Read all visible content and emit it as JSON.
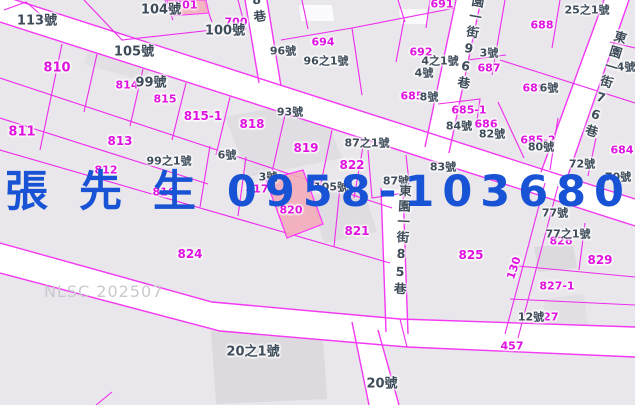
{
  "map": {
    "watermark": "NLSC 202507",
    "overlay_contact": {
      "name": "張先生",
      "phone": "0958-103680",
      "display": "張 先 生 0958-103680",
      "color": "#1753d4"
    },
    "highlighted_parcel": {
      "id": "820",
      "fill": "#f3abb9"
    },
    "colors": {
      "parcel_line": "#ee2bee",
      "road_edge_line": "#f438f4",
      "parcel_label": "#e012e0",
      "house_label": "#3e4c5a",
      "road_fill": "#ffffff",
      "map_bg": "#e9e7eb",
      "building_fill": "#dcdade",
      "watermark_color": "#c9c9cf",
      "overlay_blue": "#1753d4"
    },
    "street_labels": [
      {
        "t": "8巷",
        "x": 257,
        "y": -8,
        "r": -8
      },
      {
        "t": "園一街96巷",
        "x": 469,
        "y": -6,
        "r": 10
      },
      {
        "t": "東園一街76巷",
        "x": 604,
        "y": 28,
        "r": 17
      },
      {
        "t": "東園一街85巷",
        "x": 401,
        "y": 184,
        "r": 3
      }
    ],
    "parcel_labels": [
      {
        "t": "701",
        "x": 186,
        "y": 5
      },
      {
        "t": "700",
        "x": 236,
        "y": 22
      },
      {
        "t": "691",
        "x": 442,
        "y": 4
      },
      {
        "t": "692",
        "x": 421,
        "y": 52
      },
      {
        "t": "694",
        "x": 323,
        "y": 42
      },
      {
        "t": "687",
        "x": 489,
        "y": 68
      },
      {
        "t": "688",
        "x": 542,
        "y": 25
      },
      {
        "t": "689",
        "x": 534,
        "y": 88
      },
      {
        "t": "685",
        "x": 412,
        "y": 96
      },
      {
        "t": "685-1",
        "x": 469,
        "y": 110
      },
      {
        "t": "686",
        "x": 486,
        "y": 124
      },
      {
        "t": "685-2",
        "x": 538,
        "y": 140
      },
      {
        "t": "684",
        "x": 622,
        "y": 150
      },
      {
        "t": "810",
        "x": 57,
        "y": 68,
        "s": 13
      },
      {
        "t": "811",
        "x": 22,
        "y": 132,
        "s": 13
      },
      {
        "t": "812",
        "x": 106,
        "y": 170
      },
      {
        "t": "813",
        "x": 120,
        "y": 141,
        "s": 12
      },
      {
        "t": "814",
        "x": 127,
        "y": 85
      },
      {
        "t": "815",
        "x": 165,
        "y": 99
      },
      {
        "t": "815-1",
        "x": 203,
        "y": 116,
        "s": 12
      },
      {
        "t": "816",
        "x": 164,
        "y": 192
      },
      {
        "t": "817",
        "x": 257,
        "y": 189
      },
      {
        "t": "818",
        "x": 252,
        "y": 124,
        "s": 12
      },
      {
        "t": "819",
        "x": 306,
        "y": 148,
        "s": 12
      },
      {
        "t": "820",
        "x": 291,
        "y": 210
      },
      {
        "t": "821",
        "x": 357,
        "y": 231,
        "s": 12
      },
      {
        "t": "822",
        "x": 352,
        "y": 165,
        "s": 12
      },
      {
        "t": "824",
        "x": 190,
        "y": 254,
        "s": 12
      },
      {
        "t": "825",
        "x": 471,
        "y": 255,
        "s": 12
      },
      {
        "t": "826",
        "x": 561,
        "y": 241
      },
      {
        "t": "827",
        "x": 547,
        "y": 317
      },
      {
        "t": "827-1",
        "x": 557,
        "y": 286
      },
      {
        "t": "829",
        "x": 600,
        "y": 260,
        "s": 12
      },
      {
        "t": "457",
        "x": 512,
        "y": 346
      },
      {
        "t": "130",
        "x": 514,
        "y": 268,
        "r": -72
      }
    ],
    "house_labels": [
      {
        "t": "113號",
        "x": 37,
        "y": 21,
        "s": 13
      },
      {
        "t": "104號",
        "x": 161,
        "y": 10,
        "s": 13
      },
      {
        "t": "105號",
        "x": 134,
        "y": 52,
        "s": 13
      },
      {
        "t": "100號",
        "x": 225,
        "y": 31,
        "s": 13
      },
      {
        "t": "96號",
        "x": 283,
        "y": 51
      },
      {
        "t": "96之1號",
        "x": 326,
        "y": 61
      },
      {
        "t": "99號",
        "x": 151,
        "y": 83,
        "s": 13
      },
      {
        "t": "25之1號",
        "x": 587,
        "y": 10
      },
      {
        "t": "3號",
        "x": 489,
        "y": 53
      },
      {
        "t": "4之1號",
        "x": 440,
        "y": 61
      },
      {
        "t": "4號",
        "x": 424,
        "y": 73
      },
      {
        "t": "4號",
        "x": 626,
        "y": 67
      },
      {
        "t": "6號",
        "x": 549,
        "y": 88
      },
      {
        "t": "8號",
        "x": 429,
        "y": 97
      },
      {
        "t": "6號",
        "x": 227,
        "y": 155
      },
      {
        "t": "99之1號",
        "x": 169,
        "y": 161
      },
      {
        "t": "93號",
        "x": 290,
        "y": 112
      },
      {
        "t": "87之1號",
        "x": 367,
        "y": 143
      },
      {
        "t": "87號",
        "x": 396,
        "y": 181
      },
      {
        "t": "83號",
        "x": 443,
        "y": 167
      },
      {
        "t": "84號",
        "x": 459,
        "y": 126
      },
      {
        "t": "82號",
        "x": 492,
        "y": 134
      },
      {
        "t": "3號",
        "x": 268,
        "y": 177
      },
      {
        "t": "105號",
        "x": 331,
        "y": 187
      },
      {
        "t": "80號",
        "x": 541,
        "y": 147
      },
      {
        "t": "72號",
        "x": 582,
        "y": 164
      },
      {
        "t": "70號",
        "x": 618,
        "y": 177
      },
      {
        "t": "77號",
        "x": 555,
        "y": 213
      },
      {
        "t": "77之1號",
        "x": 568,
        "y": 234
      },
      {
        "t": "12號",
        "x": 531,
        "y": 317
      },
      {
        "t": "20之1號",
        "x": 253,
        "y": 352,
        "s": 13
      },
      {
        "t": "20號",
        "x": 382,
        "y": 384,
        "s": 13
      }
    ]
  }
}
